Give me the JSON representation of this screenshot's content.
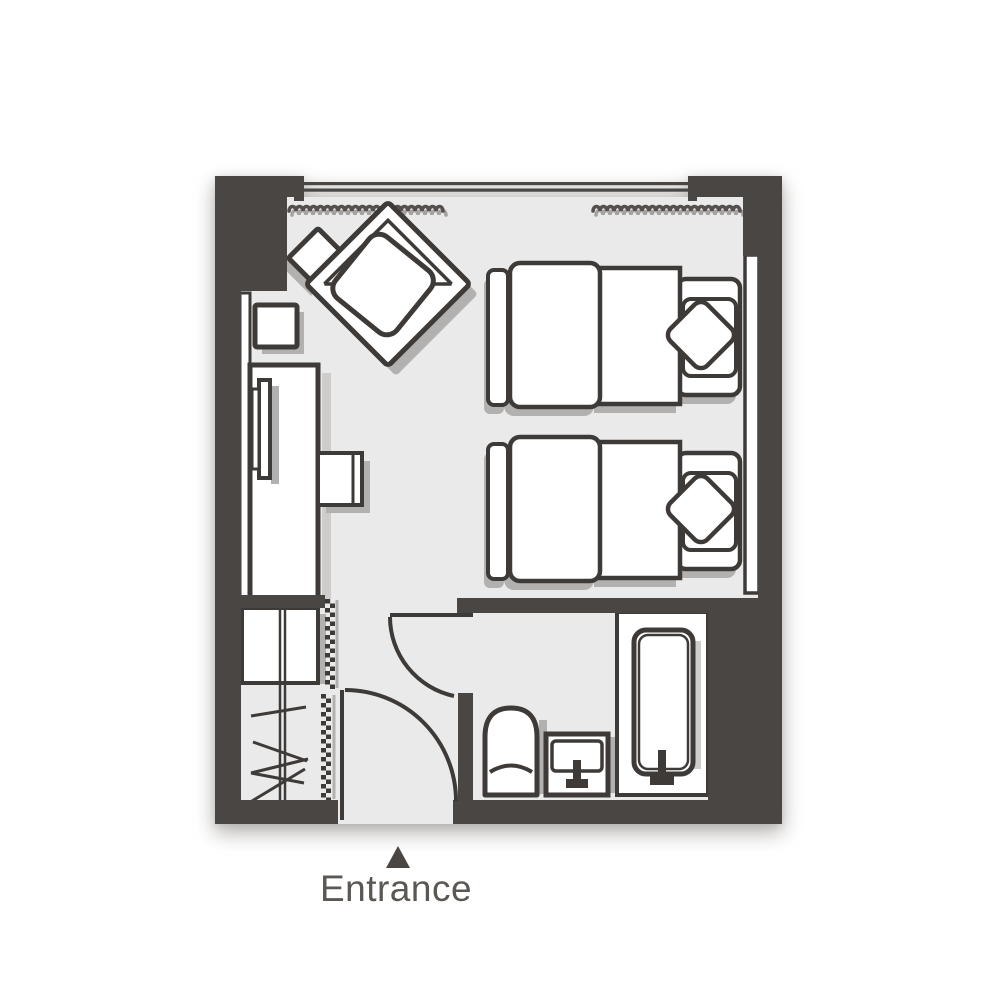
{
  "palette": {
    "wall": "#4a4643",
    "floor": "#eaeaea",
    "line": "#3e3a38",
    "white": "#ffffff",
    "shadow": "#b3b1af",
    "shadow_light": "#cfcdcb",
    "curtain": "#55504d",
    "curtain_shadow": "#a5a3a1",
    "text": "#5b5753",
    "page": "#ffffff"
  },
  "entrance": {
    "label": "Entrance",
    "marker": "up-triangle"
  },
  "floorplan": {
    "type": "hotel-twin-room-floor-plan",
    "rooms": [
      "bedroom",
      "bathroom",
      "closet",
      "entrance-vestibule"
    ],
    "furniture": [
      "window",
      "curtain-left",
      "curtain-right",
      "armchair",
      "side-table",
      "stool",
      "desk",
      "tv",
      "desk-chair",
      "wall-ledge",
      "twin-bed-1",
      "pillow-1",
      "twin-bed-2",
      "pillow-2",
      "bedside-console",
      "closet-shelf",
      "hanger-rail",
      "hangers",
      "accordion-door",
      "entrance-door",
      "bathroom-door",
      "toilet",
      "sink",
      "bathtub"
    ]
  }
}
